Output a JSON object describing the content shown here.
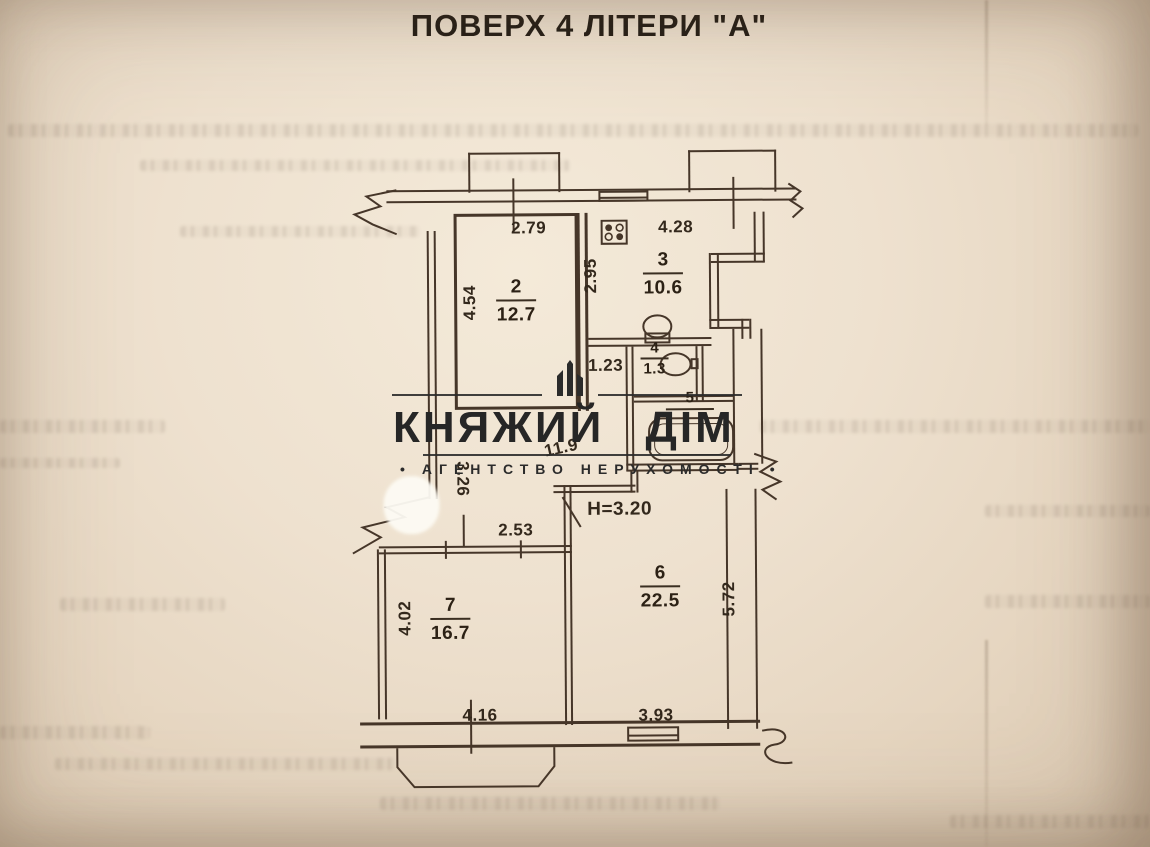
{
  "page": {
    "title": "ПОВЕРХ 4 ЛІТЕРИ \"А\""
  },
  "watermark": {
    "brand": "КНЯЖИЙ ДІМ",
    "tagline": "АГЕНТСТВО НЕРУХОМОСТІ",
    "bullet": "•"
  },
  "plan": {
    "ceiling_height_label": "Н=3.20",
    "rooms": {
      "hallway": {
        "area": "11.9"
      },
      "room2": {
        "number": "2",
        "area": "12.7"
      },
      "room3": {
        "number": "3",
        "area": "10.6"
      },
      "room4": {
        "number": "4",
        "area": "1.3"
      },
      "room5": {
        "number": "5"
      },
      "room6": {
        "number": "6",
        "area": "22.5"
      },
      "room7": {
        "number": "7",
        "area": "16.7"
      }
    },
    "dimensions": {
      "top_left": "2.79",
      "top_right": "4.28",
      "room2_left": "4.54",
      "room3_left": "2.95",
      "hall_width": "1.23",
      "hall_left": "3.26",
      "room7_door": "2.53",
      "room7_left": "4.02",
      "room6_right": "5.72",
      "bottom_left": "4.16",
      "bottom_right": "3.93"
    },
    "fixtures": [
      "stove",
      "toilet",
      "washbasin",
      "bathtub"
    ],
    "colors": {
      "paper": "#eee1cf",
      "ink": "#463629",
      "watermark": "#2b2b2b"
    }
  }
}
